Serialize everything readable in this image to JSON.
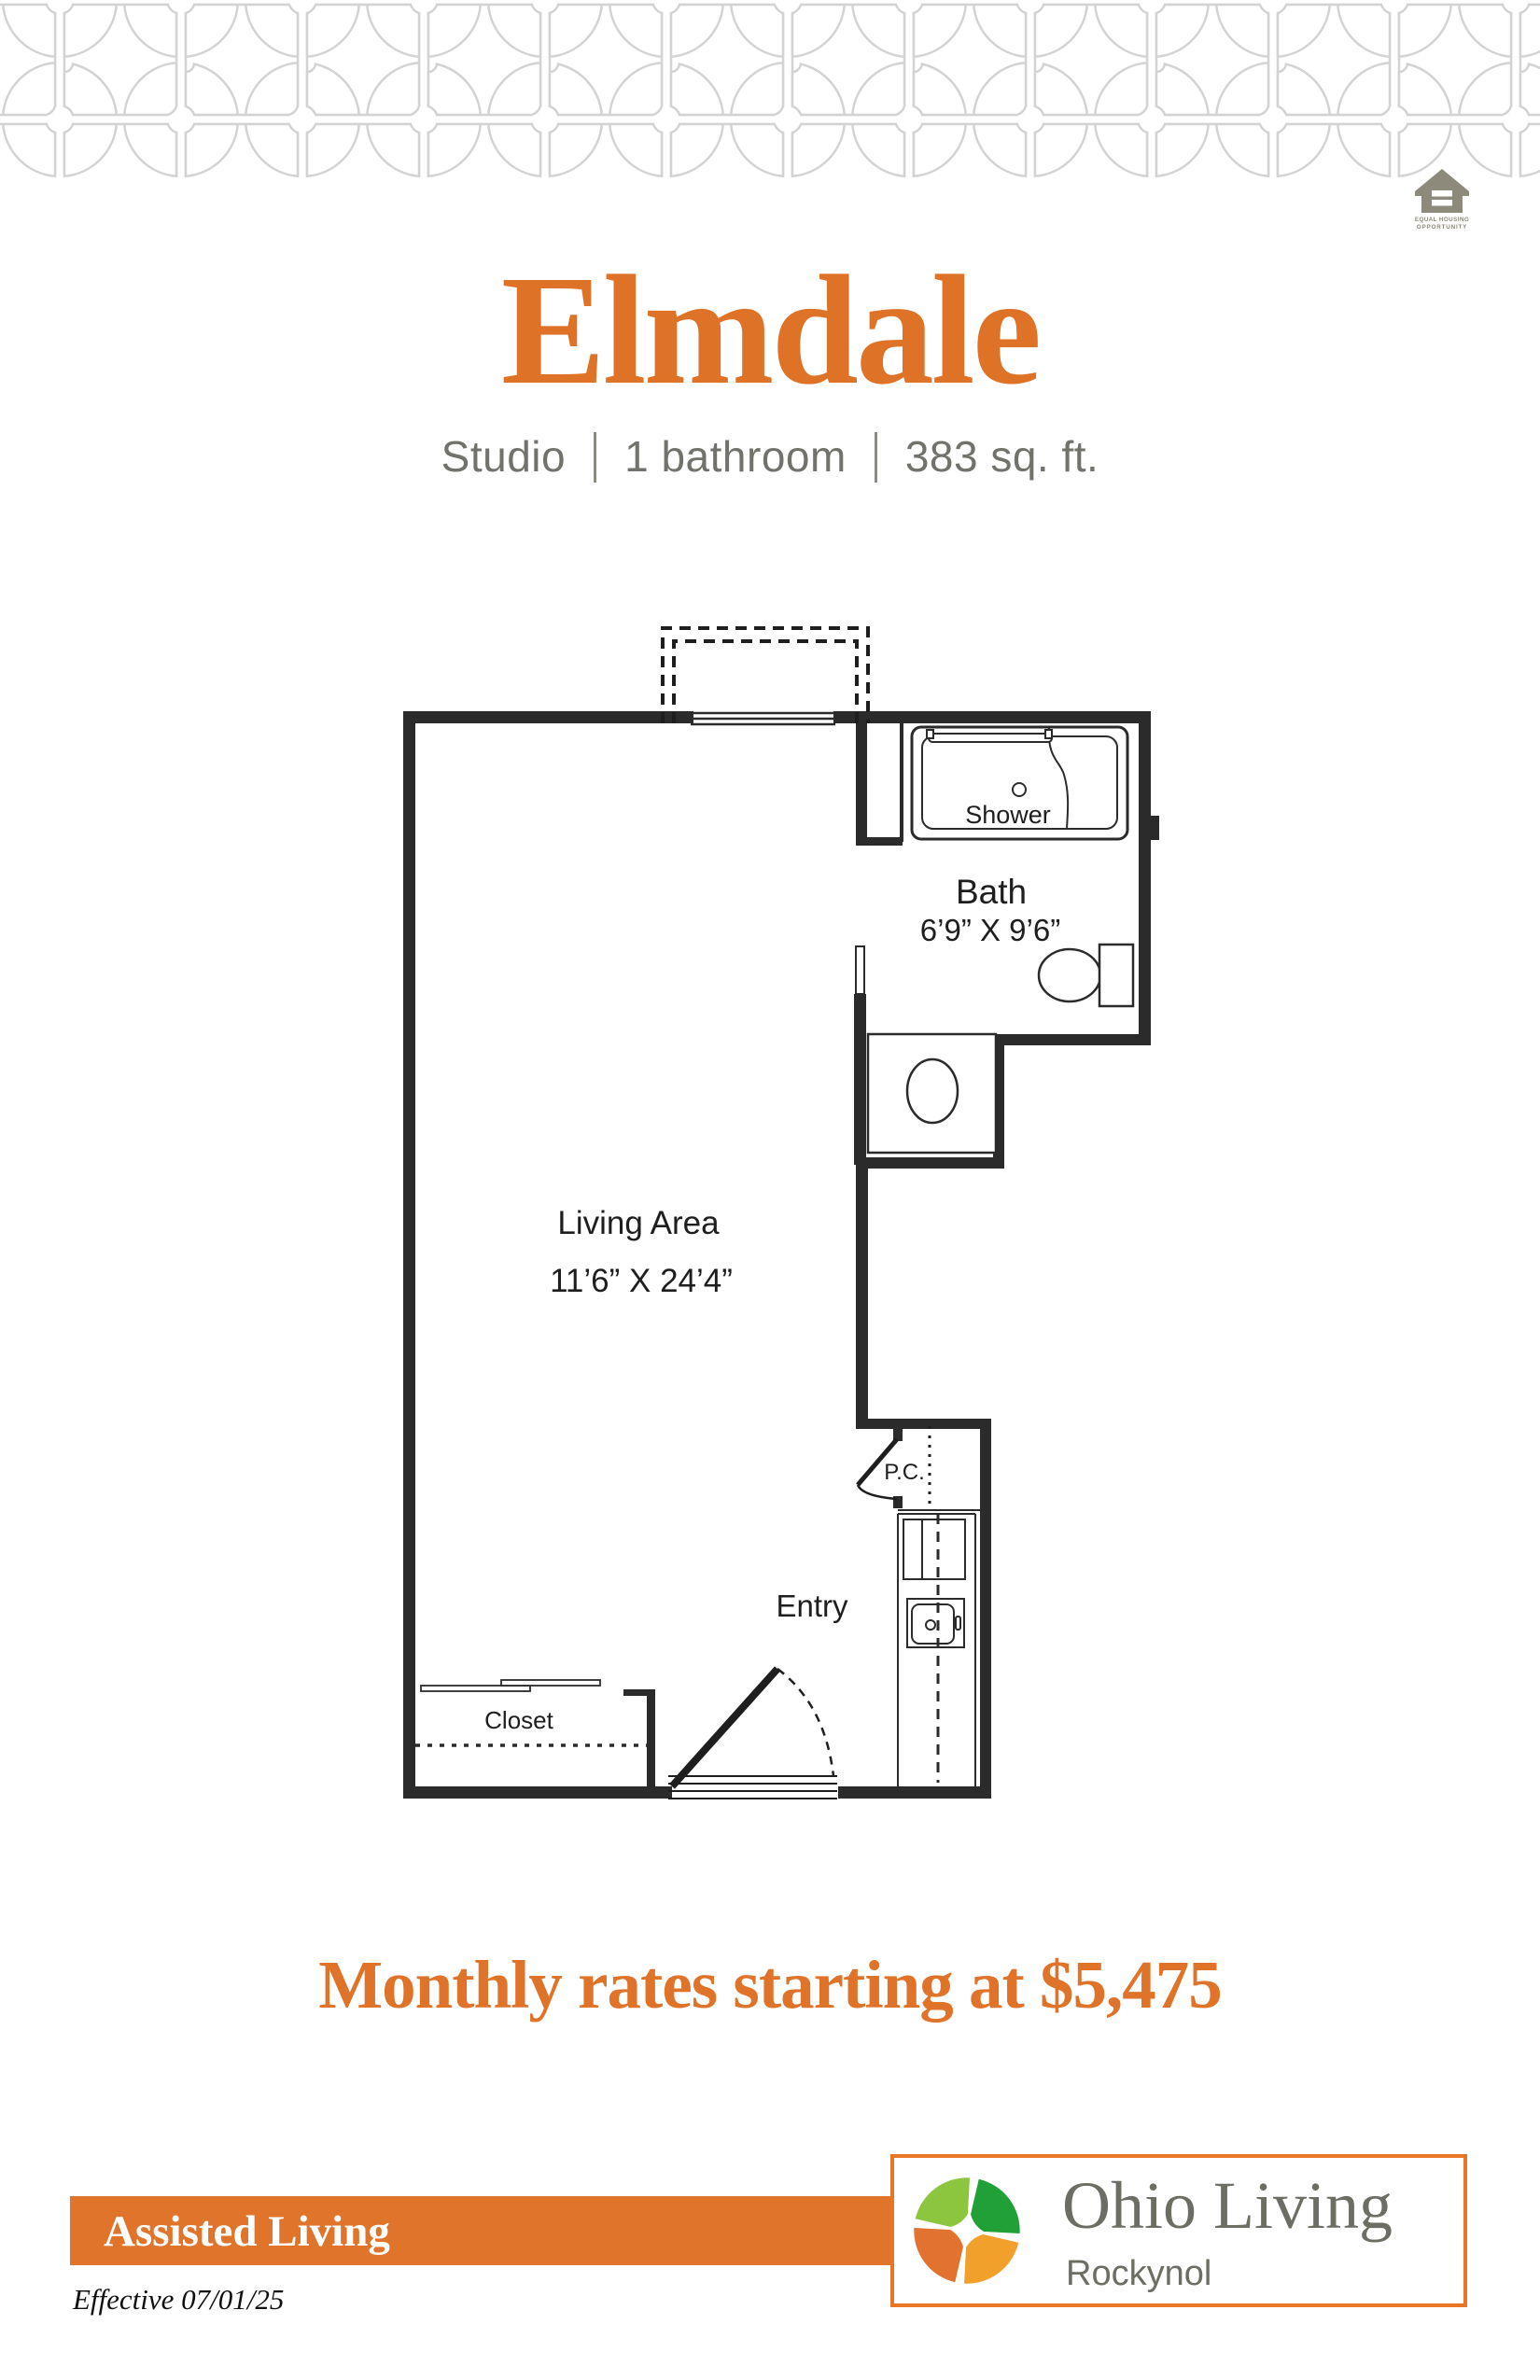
{
  "colors": {
    "accent_orange": "#E0732A",
    "bar_orange": "#E0742B",
    "box_border_orange": "#E87625",
    "pattern_gray": "#d3d3d3",
    "plan_ink": "#2b2b2b",
    "text_gray": "#70726B",
    "brand_text_gray": "#6C6E63",
    "eho_gray": "#8d8a7c",
    "mark_tl": "#8CC63F",
    "mark_tr": "#21A038",
    "mark_bl": "#E1722F",
    "mark_br": "#F2A02C"
  },
  "header": {
    "title": "Elmdale",
    "specs": [
      "Studio",
      "1 bathroom",
      "383 sq. ft."
    ]
  },
  "equal_housing": {
    "line1": "EQUAL HOUSING",
    "line2": "OPPORTUNITY"
  },
  "floorplan": {
    "labels": {
      "living": "Living Area",
      "living_dims": "11’6” X 24’4”",
      "bath": "Bath",
      "bath_dims": "6’9” X 9’6”",
      "shower": "Shower",
      "entry": "Entry",
      "pc": "P.C.",
      "closet": "Closet"
    }
  },
  "pricing": {
    "line": "Monthly rates starting at $5,475"
  },
  "footer": {
    "band": "Assisted Living",
    "effective": "Effective 07/01/25",
    "brand": {
      "name": "Ohio Living",
      "community": "Rockynol"
    }
  }
}
